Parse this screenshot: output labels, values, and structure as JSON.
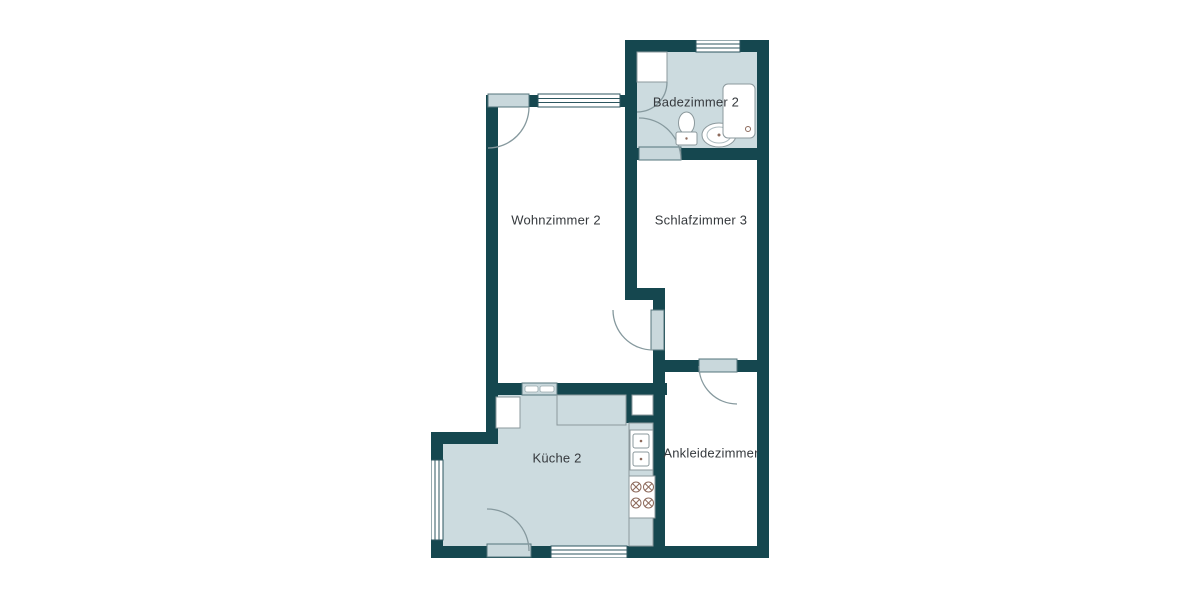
{
  "floorplan": {
    "rooms": [
      {
        "name": "Badezimmer 2",
        "type": "bathroom",
        "shaded": true
      },
      {
        "name": "Wohnzimmer 2",
        "type": "living-room",
        "shaded": false
      },
      {
        "name": "Schlafzimmer 3",
        "type": "bedroom",
        "shaded": false
      },
      {
        "name": "Küche 2",
        "type": "kitchen",
        "shaded": true
      },
      {
        "name": "Ankleidezimmer",
        "type": "dressing-room",
        "shaded": false
      }
    ],
    "fixtures": {
      "bathroom": [
        "shower-cabin",
        "toilet",
        "washbasin",
        "bathtub",
        "window"
      ],
      "kitchen": [
        "cabinet",
        "counter",
        "double-sink",
        "stove-4-burners",
        "pass-through-hatch",
        "window-left",
        "window-bottom"
      ],
      "doors": [
        "living-room-entry-door",
        "bathroom-door",
        "bedroom-living-door",
        "dressing-room-door",
        "kitchen-door"
      ]
    },
    "colors": {
      "wall": "#15474f",
      "room_shaded": "#ccdbdf",
      "room_plain": "#ffffff",
      "door_leaf": "#c9d8dc",
      "door_edge": "#54747b",
      "arc": "#86999e",
      "window": "#2c565f",
      "fixture": "#8b989c",
      "accent": "#8d6a5c"
    }
  }
}
